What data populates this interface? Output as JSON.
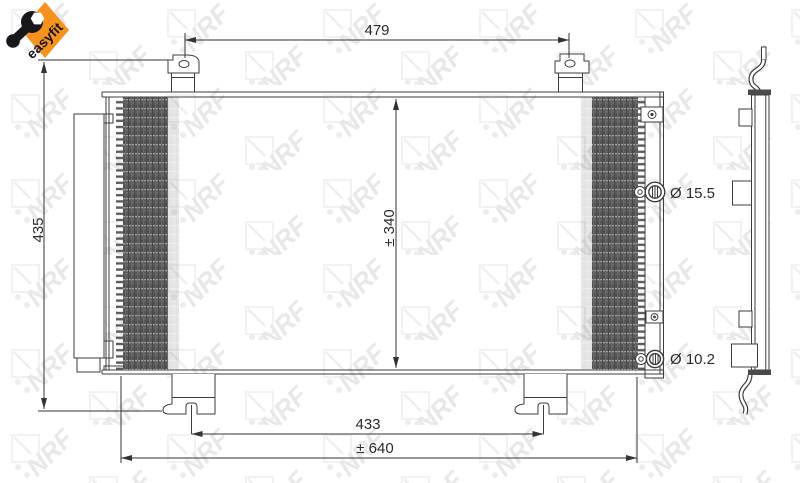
{
  "badge": {
    "label": "easyfit",
    "color": "#f6921e",
    "text_color": "#15151e",
    "icon": "wrench-icon"
  },
  "watermark": {
    "text": "NRF",
    "color": "#e7e7e7"
  },
  "drawing": {
    "title": "Condenser technical drawing, front and side view",
    "line_color": "#3d3d3d",
    "dimensions": {
      "width_top": "479",
      "height_overall": "435",
      "height_core": "± 340",
      "diameter_inlet": "Ø 15.5",
      "diameter_outlet": "Ø 10.2",
      "width_bottom_brackets": "433",
      "width_overall": "± 640"
    }
  }
}
